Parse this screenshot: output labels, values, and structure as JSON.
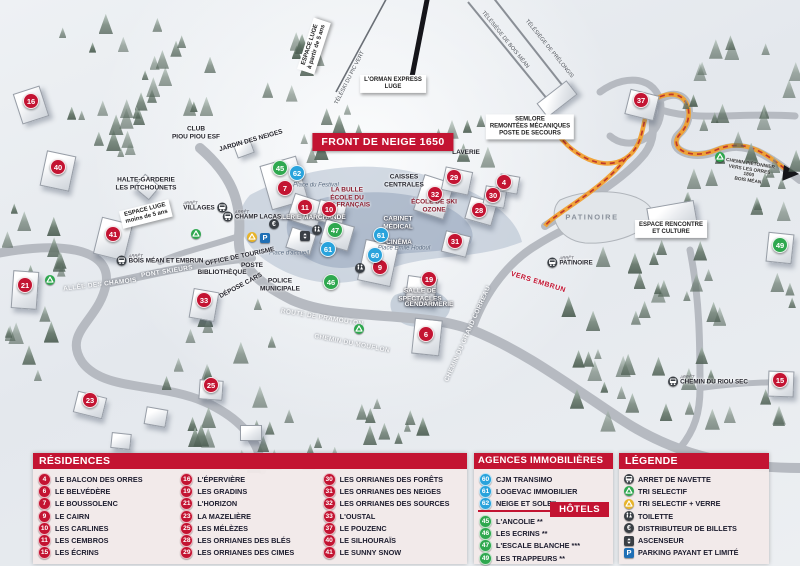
{
  "map": {
    "banner": "FRONT DE NEIGE 1650",
    "stop_prefix": "ARRÊT",
    "colors": {
      "residence_red": "#c31432",
      "agence_blue": "#29a3dc",
      "hotel_green": "#2fa84f",
      "path_orange": "#f0a030"
    },
    "markers": [
      {
        "n": "16",
        "c": "red",
        "x": 30,
        "y": 100
      },
      {
        "n": "40",
        "c": "red",
        "x": 57,
        "y": 166
      },
      {
        "n": "41",
        "c": "red",
        "x": 112,
        "y": 233
      },
      {
        "n": "21",
        "c": "red",
        "x": 24,
        "y": 284
      },
      {
        "n": "33",
        "c": "red",
        "x": 203,
        "y": 299
      },
      {
        "n": "23",
        "c": "red",
        "x": 89,
        "y": 399
      },
      {
        "n": "25",
        "c": "red",
        "x": 210,
        "y": 384
      },
      {
        "n": "7",
        "c": "red",
        "x": 284,
        "y": 187
      },
      {
        "n": "11",
        "c": "red",
        "x": 304,
        "y": 206
      },
      {
        "n": "10",
        "c": "red",
        "x": 328,
        "y": 208
      },
      {
        "n": "9",
        "c": "red",
        "x": 379,
        "y": 266
      },
      {
        "n": "32",
        "c": "red",
        "x": 434,
        "y": 193
      },
      {
        "n": "29",
        "c": "red",
        "x": 453,
        "y": 176
      },
      {
        "n": "30",
        "c": "red",
        "x": 492,
        "y": 194
      },
      {
        "n": "28",
        "c": "red",
        "x": 478,
        "y": 209
      },
      {
        "n": "31",
        "c": "red",
        "x": 454,
        "y": 240
      },
      {
        "n": "19",
        "c": "red",
        "x": 428,
        "y": 278
      },
      {
        "n": "6",
        "c": "red",
        "x": 425,
        "y": 333
      },
      {
        "n": "37",
        "c": "red",
        "x": 640,
        "y": 99
      },
      {
        "n": "4",
        "c": "red",
        "x": 503,
        "y": 181
      },
      {
        "n": "15",
        "c": "red",
        "x": 779,
        "y": 379
      },
      {
        "n": "62",
        "c": "blue",
        "x": 296,
        "y": 172
      },
      {
        "n": "61",
        "c": "blue",
        "x": 327,
        "y": 248
      },
      {
        "n": "61",
        "c": "blue",
        "x": 380,
        "y": 234
      },
      {
        "n": "60",
        "c": "blue",
        "x": 374,
        "y": 254
      },
      {
        "n": "45",
        "c": "green",
        "x": 279,
        "y": 167
      },
      {
        "n": "47",
        "c": "green",
        "x": 334,
        "y": 229
      },
      {
        "n": "46",
        "c": "green",
        "x": 330,
        "y": 281
      },
      {
        "n": "49",
        "c": "green",
        "x": 779,
        "y": 244
      }
    ],
    "labels": [
      {
        "t": "SEMLORE\nREMONTÉES MÉCANIQUES\nPOSTE DE SECOURS",
        "k": "box",
        "x": 530,
        "y": 127
      },
      {
        "t": "L'ORMAN EXPRESS\nLUGE",
        "k": "box",
        "x": 393,
        "y": 84
      },
      {
        "t": "ESPACE LUGE\nà partir de 5 ans",
        "k": "box",
        "x": 314,
        "y": 46,
        "r": -72
      },
      {
        "t": "ESPACE LUGE\nmoins de 5 ans",
        "k": "box",
        "x": 146,
        "y": 214,
        "r": -14
      },
      {
        "t": "TÉLÉSKI DU PIC VERT",
        "k": "lift",
        "x": 350,
        "y": 78,
        "r": -63
      },
      {
        "t": "TÉLÉSIÈGE DE BOIS MÉAN",
        "k": "lift",
        "x": 505,
        "y": 40,
        "r": 51
      },
      {
        "t": "TÉLÉSIÈGE DE PRÉLONGIS",
        "k": "lift",
        "x": 549,
        "y": 49,
        "r": 51
      },
      {
        "t": "CLUB\nPIOU PIOU ESF",
        "k": "dark",
        "x": 196,
        "y": 133
      },
      {
        "t": "JARDIN DES NEIGES",
        "k": "dark",
        "x": 251,
        "y": 141,
        "r": -16
      },
      {
        "t": "HALTE-GARDERIE\nLES PITCHOUNETS",
        "k": "dark",
        "x": 146,
        "y": 184
      },
      {
        "t": "Place du Festival",
        "k": "place",
        "x": 316,
        "y": 186
      },
      {
        "t": "LA BULLE\nÉCOLE DU\nSKI FRANÇAIS",
        "k": "darkred",
        "x": 347,
        "y": 198
      },
      {
        "t": "GALERIE MARCHANDE",
        "k": "white",
        "x": 309,
        "y": 218
      },
      {
        "t": "CAISSES\nCENTRALES",
        "k": "dark",
        "x": 404,
        "y": 181
      },
      {
        "t": "ÉCOLE DE SKI\nOZONE",
        "k": "darkred",
        "x": 434,
        "y": 206
      },
      {
        "t": "CABINET\nMÉDICAL",
        "k": "white",
        "x": 398,
        "y": 223
      },
      {
        "t": "CINÉMA",
        "k": "white",
        "x": 399,
        "y": 243
      },
      {
        "t": "LAVERIE",
        "k": "dark",
        "x": 466,
        "y": 153
      },
      {
        "t": "Place Émile Hodoul",
        "k": "place",
        "x": 404,
        "y": 249
      },
      {
        "t": "Place d'accueil",
        "k": "place",
        "x": 289,
        "y": 254
      },
      {
        "t": "OFFICE DE TOURISME",
        "k": "dark",
        "x": 240,
        "y": 257,
        "r": -12
      },
      {
        "t": "POSTE",
        "k": "dark",
        "x": 252,
        "y": 266
      },
      {
        "t": "BIBLIOTHÈQUE",
        "k": "dark",
        "x": 222,
        "y": 273
      },
      {
        "t": "POLICE\nMUNICIPALE",
        "k": "dark",
        "x": 280,
        "y": 285
      },
      {
        "t": "DÉPOSE CARS",
        "k": "dark",
        "x": 241,
        "y": 286,
        "r": -28
      },
      {
        "t": "ROUTE DE PRAMOUTON",
        "k": "road",
        "x": 322,
        "y": 318,
        "r": 9
      },
      {
        "t": "CHEMIN DU MOUFLON",
        "k": "road",
        "x": 352,
        "y": 344,
        "r": 11
      },
      {
        "t": "CHEMIN DU GRAND CORREAU",
        "k": "road",
        "x": 468,
        "y": 334,
        "r": -66
      },
      {
        "t": "ALLÉE DES CHAMOIS",
        "k": "road",
        "x": 100,
        "y": 285,
        "r": -7
      },
      {
        "t": "PONT SKIEURS",
        "k": "road",
        "x": 167,
        "y": 272,
        "r": -9
      },
      {
        "t": "VERS EMBRUN",
        "k": "redtext",
        "x": 538,
        "y": 283,
        "r": 17
      },
      {
        "t": "CHEMIN PIÉTONNIER\nVERS LES ORRES 1800\nBOIS MÉAN",
        "k": "tiny",
        "x": 749,
        "y": 173,
        "r": 9
      },
      {
        "t": "SALLE DE\nSPECTACLES",
        "k": "white",
        "x": 420,
        "y": 295
      },
      {
        "t": "GENDARMERIE",
        "k": "white",
        "x": 429,
        "y": 305
      },
      {
        "t": "PATINOIRE",
        "k": "gray",
        "x": 592,
        "y": 218
      },
      {
        "t": "ESPACE RENCONTRE\nET CULTURE",
        "k": "box",
        "x": 671,
        "y": 229
      }
    ],
    "bus_stops": [
      {
        "name": "VILLAGES",
        "x": 205,
        "y": 207,
        "side": "r"
      },
      {
        "name": "CHAMP LACAS",
        "x": 252,
        "y": 216,
        "side": "l"
      },
      {
        "name": "BOIS MÉAN ET EMBRUN",
        "x": 160,
        "y": 260,
        "side": "l"
      },
      {
        "name": "PATINOIRE",
        "x": 570,
        "y": 262,
        "side": "l"
      },
      {
        "name": "CHEMIN DU RIOU SEC",
        "x": 708,
        "y": 381,
        "side": "l"
      }
    ],
    "icons": [
      {
        "type": "recycle-green",
        "x": 50,
        "y": 280
      },
      {
        "type": "recycle-green",
        "x": 196,
        "y": 234
      },
      {
        "type": "recycle-green",
        "x": 720,
        "y": 157
      },
      {
        "type": "recycle-green",
        "x": 359,
        "y": 329
      },
      {
        "type": "recycle-yellow",
        "x": 252,
        "y": 237
      },
      {
        "type": "parking",
        "x": 265,
        "y": 238
      },
      {
        "type": "euro",
        "x": 274,
        "y": 224
      },
      {
        "type": "toilet",
        "x": 317,
        "y": 230
      },
      {
        "type": "toilet",
        "x": 360,
        "y": 268
      },
      {
        "type": "elevator",
        "x": 305,
        "y": 236
      }
    ]
  },
  "panels": {
    "residences": {
      "title": "RÉSIDENCES",
      "items": [
        {
          "n": "4",
          "label": "LE BALCON DES ORRES"
        },
        {
          "n": "6",
          "label": "LE BELVÉDÈRE"
        },
        {
          "n": "7",
          "label": "LE BOUSSOLENC"
        },
        {
          "n": "9",
          "label": "LE CAIRN"
        },
        {
          "n": "10",
          "label": "LES CARLINES"
        },
        {
          "n": "11",
          "label": "LES CEMBROS"
        },
        {
          "n": "15",
          "label": "LES ÉCRINS"
        },
        {
          "n": "16",
          "label": "L'ÉPERVIÈRE"
        },
        {
          "n": "19",
          "label": "LES GRADINS"
        },
        {
          "n": "21",
          "label": "L'HORIZON"
        },
        {
          "n": "23",
          "label": "LA MAZELIÈRE"
        },
        {
          "n": "25",
          "label": "LES MÉLÈZES"
        },
        {
          "n": "28",
          "label": "LES ORRIANES DES BLÉS"
        },
        {
          "n": "29",
          "label": "LES ORRIANES DES CIMES"
        },
        {
          "n": "30",
          "label": "LES ORRIANES DES FORÊTS"
        },
        {
          "n": "31",
          "label": "LES ORRIANES DES NEIGES"
        },
        {
          "n": "32",
          "label": "LES ORRIANES DES SOURCES"
        },
        {
          "n": "33",
          "label": "L'OUSTAL"
        },
        {
          "n": "37",
          "label": "LE POUZENC"
        },
        {
          "n": "40",
          "label": "LE SILHOURAÏS"
        },
        {
          "n": "41",
          "label": "LE SUNNY SNOW"
        }
      ]
    },
    "agences": {
      "title": "AGENCES IMMOBILIÈRES",
      "items": [
        {
          "n": "60",
          "label": "CJM TRANSIMO"
        },
        {
          "n": "61",
          "label": "LOGEVAC IMMOBILIER"
        },
        {
          "n": "62",
          "label": "NEIGE ET SOLEIL"
        }
      ]
    },
    "hotels": {
      "title": "HÔTELS",
      "items": [
        {
          "n": "45",
          "label": "L'ANCOLIE **"
        },
        {
          "n": "46",
          "label": "LES ECRINS **"
        },
        {
          "n": "47",
          "label": "L'ESCALE BLANCHE ***"
        },
        {
          "n": "49",
          "label": "LES TRAPPEURS **"
        }
      ]
    },
    "legende": {
      "title": "LÉGENDE",
      "items": [
        {
          "icon": "bus",
          "label": "ARRET DE NAVETTE"
        },
        {
          "icon": "recycle-green",
          "label": "TRI SELECTIF"
        },
        {
          "icon": "recycle-yellow",
          "label": "TRI SELECTIF + VERRE"
        },
        {
          "icon": "toilet",
          "label": "TOILETTE"
        },
        {
          "icon": "euro",
          "label": "DISTRIBUTEUR DE BILLETS"
        },
        {
          "icon": "elevator",
          "label": "ASCENSEUR"
        },
        {
          "icon": "parking",
          "label": "PARKING PAYANT ET LIMITÉ"
        }
      ]
    }
  }
}
